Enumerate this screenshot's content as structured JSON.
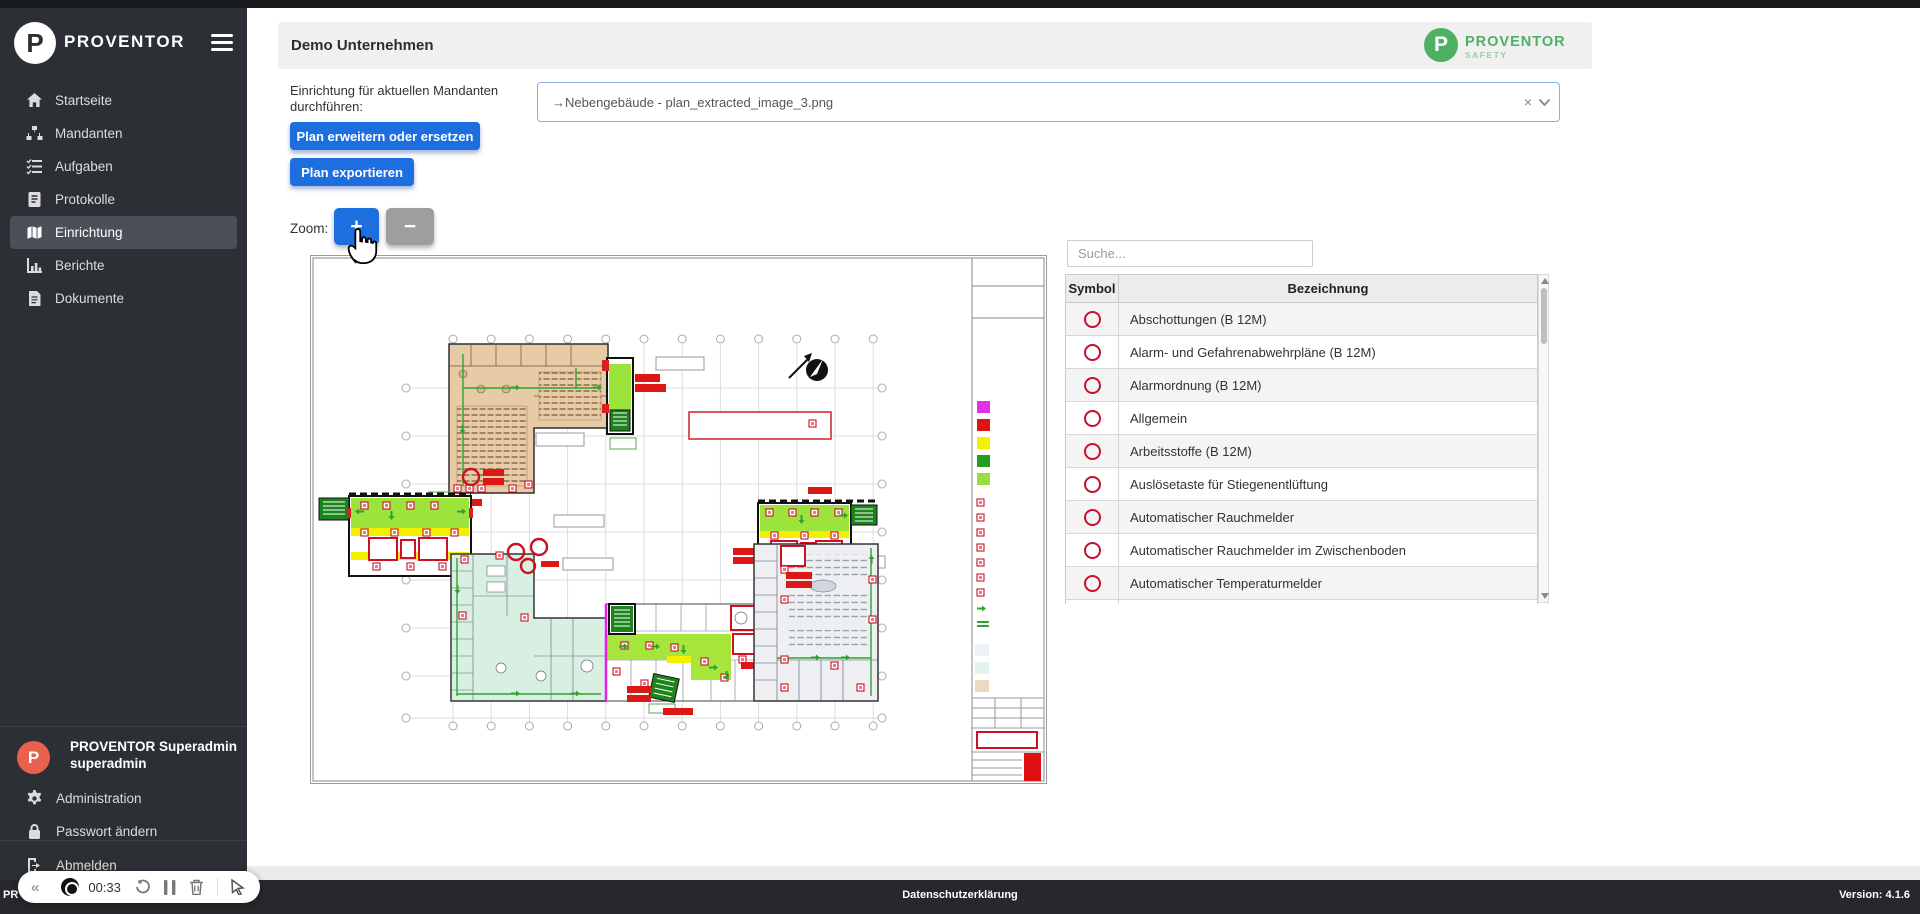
{
  "app": {
    "top_strip_color": "#17191c",
    "accent_blue": "#1d6ede",
    "brand_green": "#4db063",
    "ring_red": "#c8102e",
    "sidebar_bg": "#2c2f34",
    "avatar_color": "#e8614d"
  },
  "sidebar": {
    "brand": "PROVENTOR",
    "brand_initial": "P",
    "items": [
      {
        "label": "Startseite"
      },
      {
        "label": "Mandanten"
      },
      {
        "label": "Aufgaben"
      },
      {
        "label": "Protokolle"
      },
      {
        "label": "Einrichtung",
        "active": true
      },
      {
        "label": "Berichte"
      },
      {
        "label": "Dokumente"
      }
    ],
    "user": {
      "initial": "P",
      "name": "PROVENTOR Superadmin",
      "username": "superadmin"
    },
    "footer_items": [
      {
        "label": "Administration"
      },
      {
        "label": "Passwort ändern"
      },
      {
        "label": "Abmelden"
      }
    ]
  },
  "header": {
    "title": "Demo Unternehmen",
    "safety_logo": {
      "initial": "P",
      "line1": "PROVENTOR",
      "line2": "SAFETY"
    }
  },
  "toolbar": {
    "label_line1": "Einrichtung für aktuellen Mandanten",
    "label_line2": "durchführen:",
    "extend_button": "Plan erweitern oder ersetzen",
    "export_button": "Plan exportieren",
    "zoom_label": "Zoom:",
    "zoom_in": "+",
    "zoom_out": "−"
  },
  "plan_select": {
    "value": "→Nebengebäude - plan_extracted_image_3.png",
    "clear_icon": "×"
  },
  "symbols_panel": {
    "search_placeholder": "Suche...",
    "columns": {
      "symbol": "Symbol",
      "name": "Bezeichnung"
    },
    "rows": [
      {
        "label": "Abschottungen (B 12M)"
      },
      {
        "label": "Alarm- und Gefahrenabwehrpläne (B 12M)"
      },
      {
        "label": "Alarmordnung (B 12M)"
      },
      {
        "label": "Allgemein"
      },
      {
        "label": "Arbeitsstoffe (B 12M)"
      },
      {
        "label": "Auslösetaste für Stiegenentlüftung"
      },
      {
        "label": "Automatischer Rauchmelder"
      },
      {
        "label": "Automatischer Rauchmelder im Zwischenboden"
      },
      {
        "label": "Automatischer Temperaturmelder"
      }
    ]
  },
  "recorder": {
    "collapse": "«",
    "time": "00:33"
  },
  "footer": {
    "left": "PR",
    "center": "Datenschutzerklärung",
    "right": "Version: 4.1.6"
  }
}
